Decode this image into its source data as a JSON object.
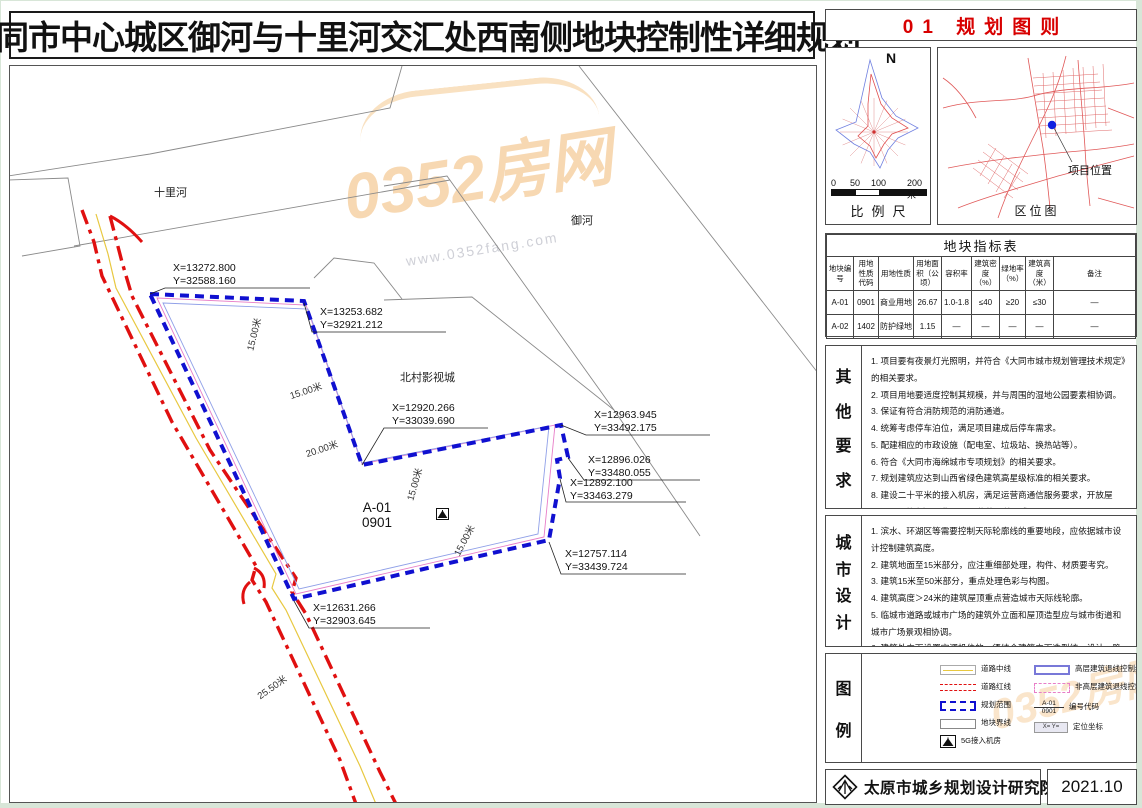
{
  "title": "大同市中心城区御河与十里河交汇处西南侧地块控制性详细规划",
  "sheet_title": "01 规划图则",
  "compass": {
    "north_label": "N"
  },
  "scalebar": {
    "ticks": [
      "0",
      "50",
      "100",
      "200米"
    ],
    "label": "比例尺"
  },
  "location_map": {
    "caption": "区位图",
    "marker_label": "项目位置"
  },
  "table": {
    "title": "地块指标表",
    "headers": [
      "地块编号",
      "用地性质代码",
      "用地性质",
      "用地面积（公顷）",
      "容积率",
      "建筑密度（%）",
      "绿地率（%）",
      "建筑高度（米）",
      "备注"
    ],
    "rows": [
      [
        "A-01",
        "0901",
        "商业用地",
        "26.67",
        "1.0-1.8",
        "≤40",
        "≥20",
        "≤30",
        "—"
      ],
      [
        "A-02",
        "1402",
        "防护绿地",
        "1.15",
        "—",
        "—",
        "—",
        "—",
        "—"
      ]
    ]
  },
  "other_requirements": {
    "label": "其他要求",
    "items": [
      "1. 项目要有夜景灯光照明，并符合《大同市城市规划管理技术规定》的相关要求。",
      "2. 项目用地要适度控制其规模，并与周围的湿地公园要素相协调。",
      "3. 保证有符合消防规范的消防通道。",
      "4. 统筹考虑停车泊位，满足项目建成后停车需求。",
      "5. 配建相应的市政设施（配电室、垃圾站、换热站等）。",
      "6. 符合《大同市海绵城市专项规划》的相关要求。",
      "7. 规划建筑应达到山西省绿色建筑高星级标准的相关要求。",
      "8. 建设二十平米的接入机房，满足运营商通信服务要求，开放屋顶，及公共空间，满足5G通信的覆盖要求。",
      "9. 土地用途变更前应按照规定进行土壤污染状况调查，对存在污染的土地，在土地修复后，应征得大同市生态环保局意见，经生态环保局同意后方可进行开发建设。"
    ]
  },
  "urban_design": {
    "label": "城市设计",
    "items": [
      "1. 滨水、环湖区等需要控制天际轮廓线的重要地段，应依据城市设计控制建筑高度。",
      "2. 建筑地面至15米部分，应注重细部处理，构件、材质要考究。",
      "3. 建筑15米至50米部分，重点处理色彩与构图。",
      "4. 建筑高度＞24米的建筑屋顶重点营造城市天际线轮廓。",
      "5. 临城市道路或城市广场的建筑外立面和屋顶造型应与城市街道和城市广场景观相协调。",
      "6. 建筑外立面设置空调机位的，须结合建筑立面造型统一设计，隐蔽处理。",
      "7. 建筑外立面色彩应按照《大同城市环境色彩体系》进行配色。",
      "8. 基调色应占建筑外立面总体面积70%左右，辅助色占25%左右，强调色占5%左右。"
    ]
  },
  "legend": {
    "label": "图例",
    "left": [
      "道路中线",
      "道路红线",
      "规划范围",
      "地块界线",
      "5G接入机房"
    ],
    "right": [
      "高层建筑退线控制线",
      "非高层建筑退线控制线",
      "编号代码",
      "定位坐标"
    ],
    "code_sample": {
      "top": "A-01",
      "bottom": "0901"
    },
    "coord_sample": {
      "x": "X=",
      "y": "Y="
    }
  },
  "footer": {
    "institute": "太原市城乡规划设计研究院",
    "date": "2021.10"
  },
  "map": {
    "river1": "十里河",
    "river2": "御河",
    "site": "北村影视城",
    "plot": {
      "code": "A-01",
      "use_code": "0901"
    },
    "coords": [
      {
        "x": "X=13272.800",
        "y": "Y=32588.160"
      },
      {
        "x": "X=13253.682",
        "y": "Y=32921.212"
      },
      {
        "x": "X=12920.266",
        "y": "Y=33039.690"
      },
      {
        "x": "X=12963.945",
        "y": "Y=33492.175"
      },
      {
        "x": "X=12896.026",
        "y": "Y=33480.055"
      },
      {
        "x": "X=12892.100",
        "y": "Y=33463.279"
      },
      {
        "x": "X=12757.114",
        "y": "Y=33439.724"
      },
      {
        "x": "X=12631.266",
        "y": "Y=32903.645"
      }
    ],
    "dims": [
      "15.00米",
      "15.00米",
      "20.00米",
      "15.00米",
      "15.00米",
      "25.50米"
    ]
  },
  "watermark": {
    "text": "0352房网",
    "url": "www.0352fang.com"
  },
  "colors": {
    "accent_red": "#d80000",
    "boundary_blue": "#1010d0",
    "road_red": "#e01010",
    "road_yellow": "#e8c840",
    "setback_pink": "#e87ec8",
    "setback_blue": "#90a0e8",
    "marker_blue": "#1020e0"
  }
}
